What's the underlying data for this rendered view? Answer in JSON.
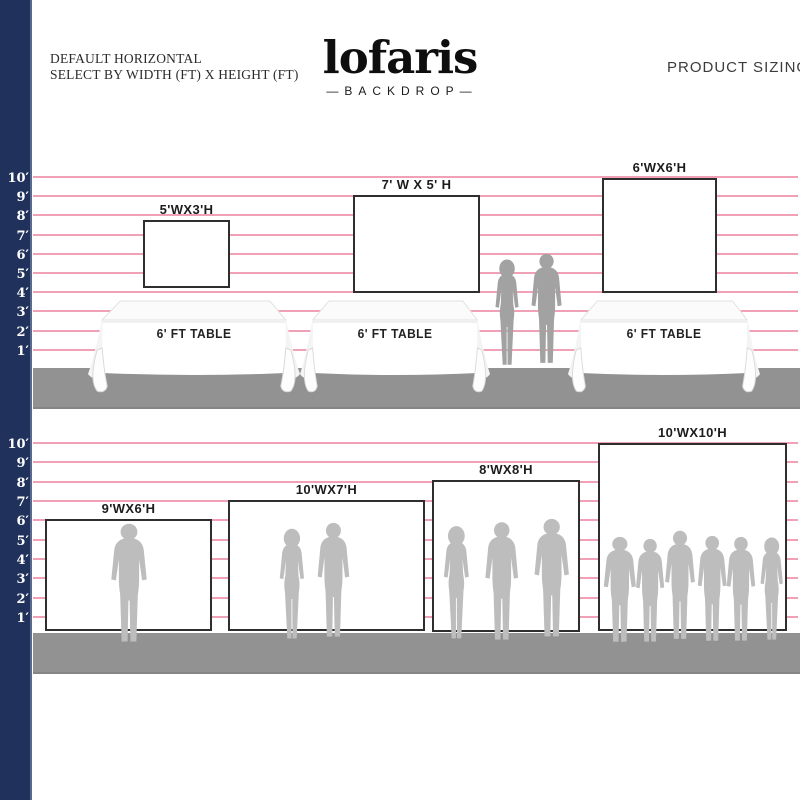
{
  "header": {
    "subtitle_line1": "DEFAULT HORIZONTAL",
    "subtitle_line2": "SELECT BY WIDTH (FT) X HEIGHT (FT)",
    "logo_text": "lofaris",
    "logo_subtitle": "—BACKDROP—",
    "product_sizing": "PRODUCT SIZING"
  },
  "colors": {
    "sidebar_navy": "#20325c",
    "grid_pink": "#f0a1b5",
    "floor_gray": "#929292",
    "silhouette_top": "#a2a2a2",
    "silhouette_bottom": "#bdbdbd",
    "backdrop_border": "#2e2e2e"
  },
  "ruler": [
    "10′",
    "9′",
    "8′",
    "7′",
    "6′",
    "5′",
    "4′",
    "3′",
    "2′",
    "1′"
  ],
  "sections": {
    "top": {
      "backdrops": [
        {
          "label": "5'WX3'H",
          "width_ft": 5,
          "height_ft": 3
        },
        {
          "label": "7' W X 5' H",
          "width_ft": 7,
          "height_ft": 5
        },
        {
          "label": "6'WX6'H",
          "width_ft": 6,
          "height_ft": 6
        }
      ],
      "tables": [
        {
          "label": "6' FT TABLE"
        },
        {
          "label": "6' FT TABLE"
        },
        {
          "label": "6' FT TABLE"
        }
      ],
      "people_silhouettes": 2
    },
    "bottom": {
      "backdrops": [
        {
          "label": "9'WX6'H",
          "width_ft": 9,
          "height_ft": 6,
          "people_silhouettes": 1
        },
        {
          "label": "10'WX7'H",
          "width_ft": 10,
          "height_ft": 7,
          "people_silhouettes": 2
        },
        {
          "label": "8'WX8'H",
          "width_ft": 8,
          "height_ft": 8,
          "people_silhouettes": 3
        },
        {
          "label": "10'WX10'H",
          "width_ft": 10,
          "height_ft": 10,
          "people_silhouettes": 6
        }
      ]
    }
  }
}
